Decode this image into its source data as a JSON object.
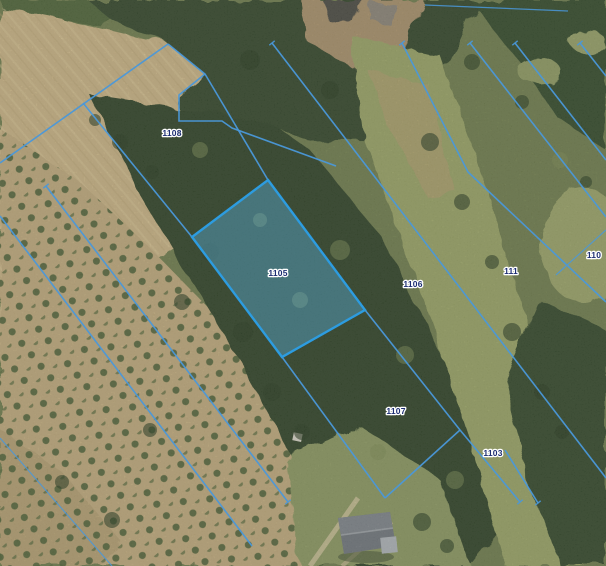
{
  "map": {
    "selected_parcel_number": "1105",
    "labels": [
      {
        "text": "1108"
      },
      {
        "text": "1105"
      },
      {
        "text": "1106"
      },
      {
        "text": "111"
      },
      {
        "text": "1107"
      },
      {
        "text": "1103"
      },
      {
        "text": "110"
      }
    ],
    "colors": {
      "boundary_line": "#4a98da",
      "selected_fill": "#5ab4e4",
      "selected_border": "#2d9ce0",
      "label_text": "#1d2e73",
      "label_halo": "#ffffff"
    }
  }
}
